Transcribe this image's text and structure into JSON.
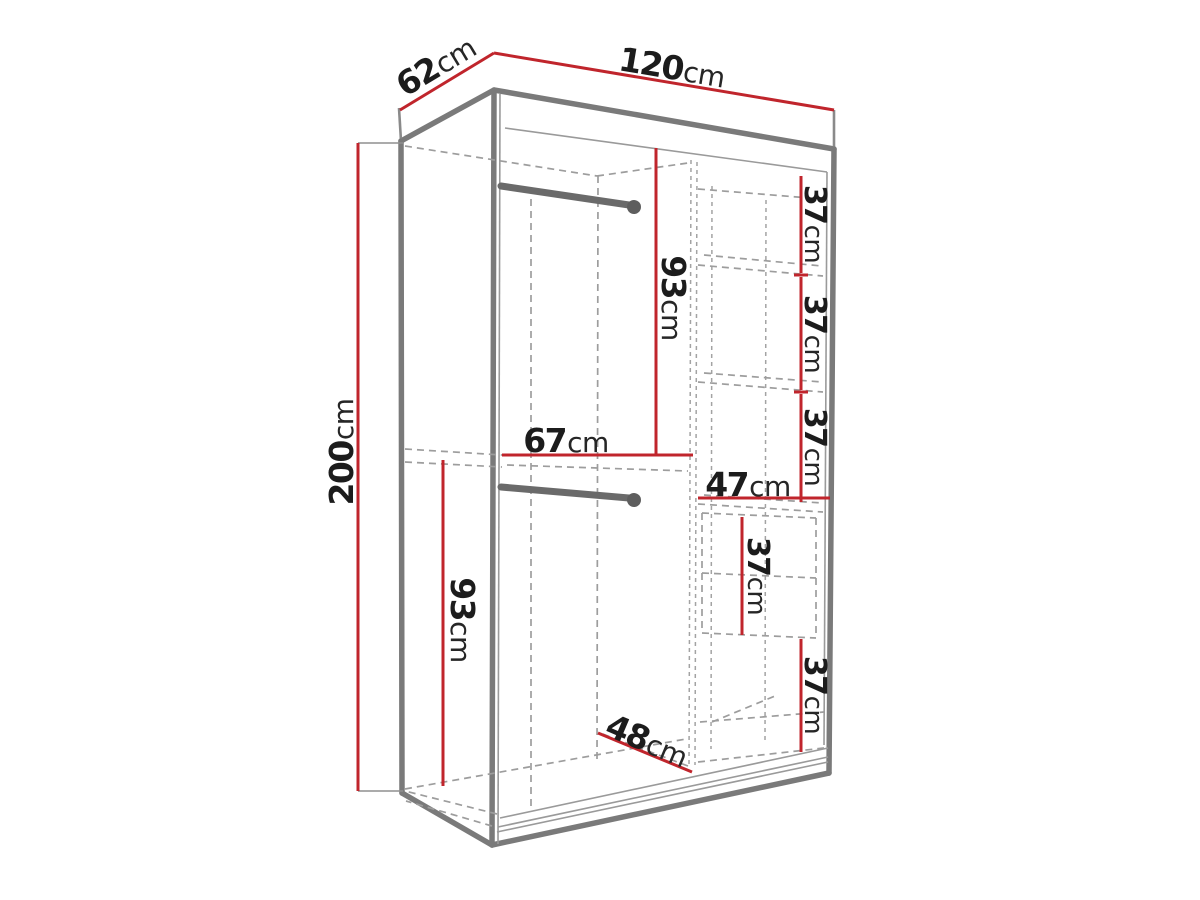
{
  "diagram": {
    "type": "wardrobe-dimension-drawing",
    "unit": "cm",
    "view": "perspective-front-left",
    "colors": {
      "dimension_line": "#c0252c",
      "outline": "#7a7a7a",
      "hidden_line": "#9d9d9d",
      "label_text": "#1c1c1c",
      "background": "#ffffff"
    },
    "labels": {
      "depth": {
        "num": "62",
        "unit": "cm"
      },
      "width": {
        "num": "120",
        "unit": "cm"
      },
      "height": {
        "num": "200",
        "unit": "cm"
      },
      "upper_section_height": {
        "num": "93",
        "unit": "cm"
      },
      "left_section_width": {
        "num": "67",
        "unit": "cm"
      },
      "right_section_width": {
        "num": "47",
        "unit": "cm"
      },
      "shelf_gap_1": {
        "num": "37",
        "unit": "cm"
      },
      "shelf_gap_2": {
        "num": "37",
        "unit": "cm"
      },
      "shelf_gap_3": {
        "num": "37",
        "unit": "cm"
      },
      "drawer_section_height": {
        "num": "37",
        "unit": "cm"
      },
      "bottom_shelf_gap": {
        "num": "37",
        "unit": "cm"
      },
      "lower_section_height": {
        "num": "93",
        "unit": "cm"
      },
      "interior_floor_depth": {
        "num": "48",
        "unit": "cm"
      }
    }
  }
}
